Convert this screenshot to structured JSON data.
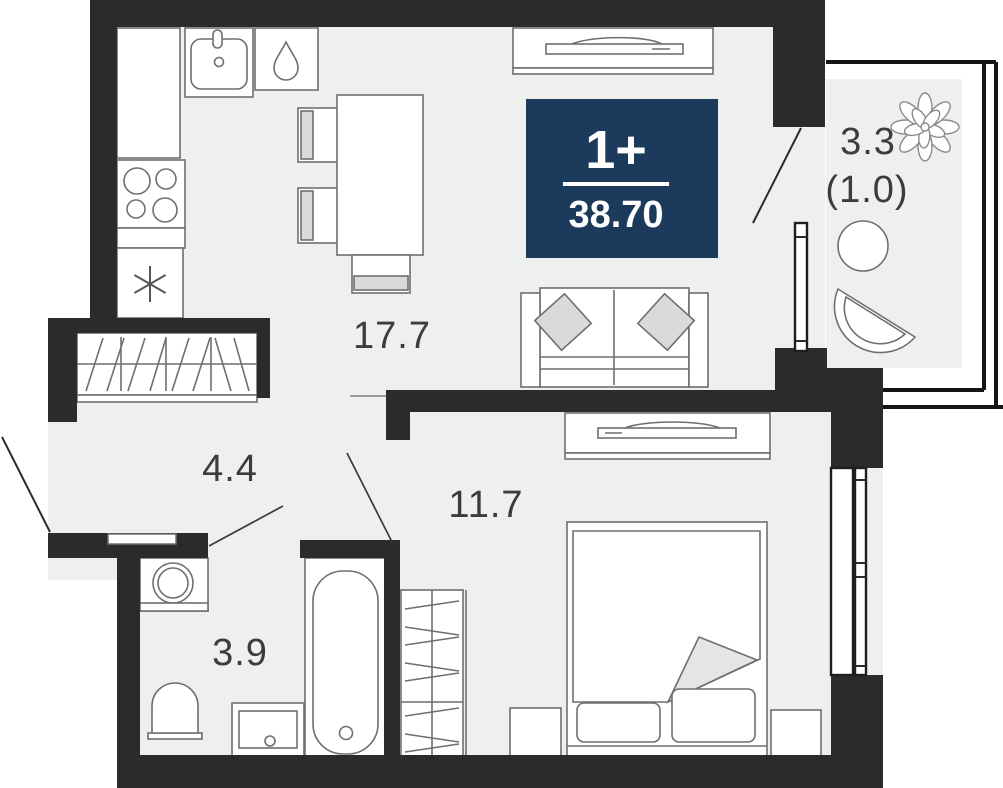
{
  "plan": {
    "title": "apartment-floor-plan",
    "badge": {
      "rooms_label": "1+",
      "area_value": "38.70",
      "bg_color": "#1b3a5c",
      "text_color": "#ffffff"
    },
    "rooms": [
      {
        "name": "living-kitchen",
        "area_label": "17.7",
        "furniture": [
          "kitchen-sink",
          "dishwasher",
          "stove",
          "fridge",
          "tall-cabinet",
          "dining-table",
          "chairs",
          "tv-stand",
          "sofa"
        ]
      },
      {
        "name": "hallway",
        "area_label": "4.4",
        "furniture": [
          "wardrobe",
          "entrance-door"
        ]
      },
      {
        "name": "bedroom",
        "area_label": "11.7",
        "furniture": [
          "tv-stand",
          "bed",
          "nightstands",
          "wardrobe",
          "window",
          "radiator"
        ]
      },
      {
        "name": "bathroom",
        "area_label": "3.9",
        "furniture": [
          "washing-machine",
          "toilet",
          "vanity-sink",
          "bathtub"
        ]
      },
      {
        "name": "balcony",
        "area_label": "3.3",
        "reduced_area_label": "(1.0)",
        "furniture": [
          "plant",
          "round-table",
          "fan-chair",
          "glazing"
        ]
      }
    ],
    "colors": {
      "wall": "#2b2b2b",
      "floor": "#eef0ee",
      "furniture_outline": "#6f6f6f",
      "label_text": "#3c3c3c",
      "badge_bg": "#1b3a5c"
    }
  }
}
